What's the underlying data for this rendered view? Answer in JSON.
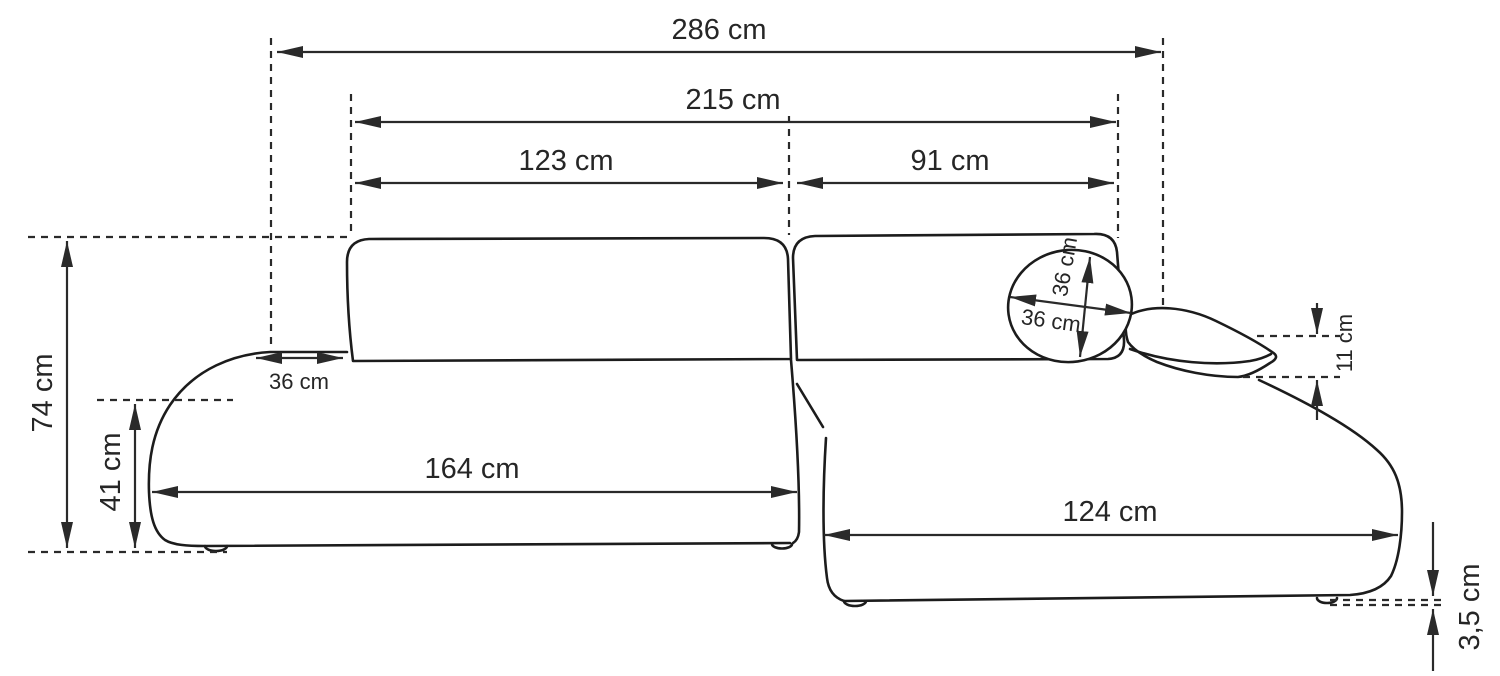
{
  "diagram": {
    "type": "sofa-dimension-drawing",
    "unit": "cm",
    "labels": {
      "total_width": "286 cm",
      "backrest_total_width": "215 cm",
      "backrest_left_width": "123 cm",
      "backrest_right_width": "91 cm",
      "overall_height": "74 cm",
      "seat_height": "41 cm",
      "armrest_top_depth": "36 cm",
      "pillow_diameter_horizontal": "36 cm",
      "pillow_diameter_vertical": "36 cm",
      "arm_cushion_thickness": "11 cm",
      "left_seat_length": "164 cm",
      "chaise_length": "124 cm",
      "leg_height": "3,5 cm"
    },
    "colors": {
      "outline": "#1c1c1c",
      "dimension_line": "#2a2a2a",
      "text": "#262626",
      "background": "#ffffff"
    }
  }
}
